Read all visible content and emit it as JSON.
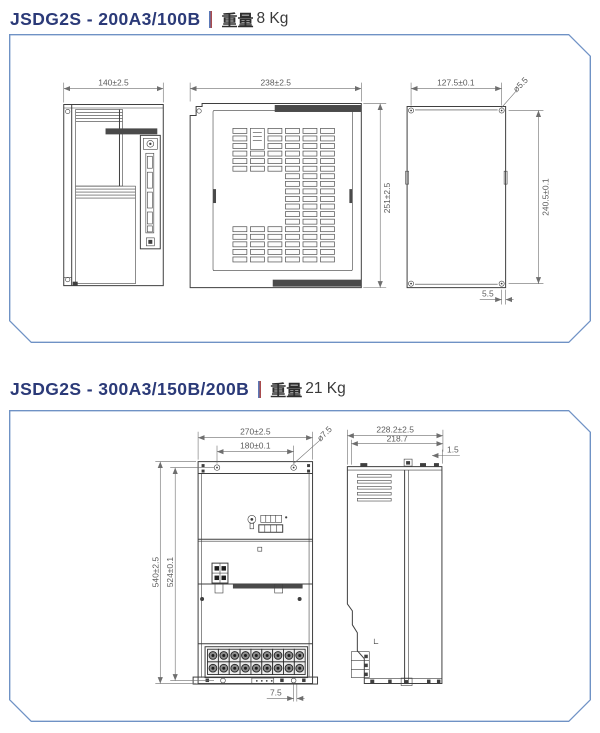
{
  "sections": [
    {
      "model": "JSDG2S - 200A3/100B",
      "weight_label": "重量",
      "weight_value": "8 Kg",
      "dims": {
        "front_width": "140±2.5",
        "top_width": "238±2.5",
        "top_height": "251±2.5",
        "mount_width": "127.5±0.1",
        "mount_hole": "ø5.5",
        "mount_height": "240.5±0.1",
        "mount_offset": "5.5"
      }
    },
    {
      "model": "JSDG2S - 300A3/150B/200B",
      "weight_label": "重量",
      "weight_value": "21 Kg",
      "dims": {
        "front_width": "270±2.5",
        "hole_pitch": "180±0.1",
        "hole_dia": "ø7.5",
        "front_height": "540±2.5",
        "hole_pitch_v": "524±0.1",
        "bottom_offset": "7.5",
        "side_depth": "228.2±2.5",
        "side_depth_inner": "218.7",
        "side_offset": "1.5"
      }
    }
  ],
  "colors": {
    "panel_border": "#6f92c5",
    "title_text": "#2b3a78",
    "divider_blue": "#5b79b8",
    "divider_red": "#a94b4d",
    "line": "#3f3f3f",
    "dim_text": "#5c5c5c"
  }
}
